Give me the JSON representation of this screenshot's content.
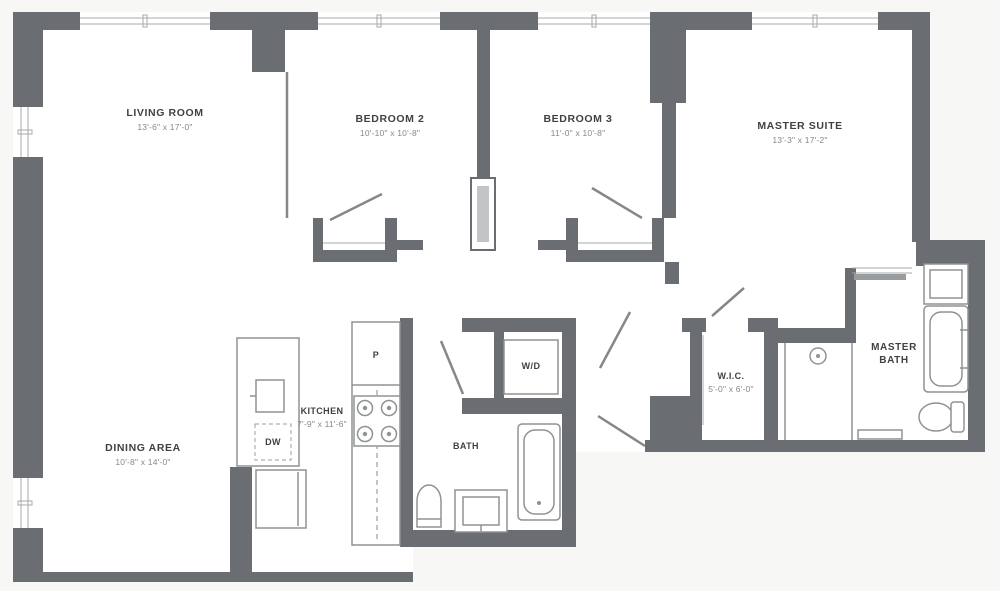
{
  "plan": {
    "rooms": {
      "living_room": {
        "name": "LIVING ROOM",
        "dims": "13'-6\" x 17'-0\""
      },
      "bedroom_2": {
        "name": "BEDROOM 2",
        "dims": "10'-10\" x 10'-8\""
      },
      "bedroom_3": {
        "name": "BEDROOM 3",
        "dims": "11'-0\" x 10'-8\""
      },
      "master_suite": {
        "name": "MASTER SUITE",
        "dims": "13'-3\" x 17'-2\""
      },
      "dining_area": {
        "name": "DINING AREA",
        "dims": "10'-8\" x 14'-0\""
      },
      "kitchen": {
        "name": "KITCHEN",
        "dims": "7'-9\" x 11'-6\""
      },
      "wic": {
        "name": "W.I.C.",
        "dims": "5'-0\" x 6'-0\""
      },
      "bath": {
        "name": "BATH"
      },
      "master_bath": {
        "name": "MASTER BATH"
      },
      "laundry": {
        "name": "W/D"
      },
      "dishwasher": {
        "name": "DW"
      },
      "pantry": {
        "name": "P"
      }
    }
  },
  "colors": {
    "wall": "#6a6d71",
    "bg": "#f7f7f5",
    "fixture": "#8f9294",
    "label": "#3f4245",
    "dims": "#85888b"
  }
}
